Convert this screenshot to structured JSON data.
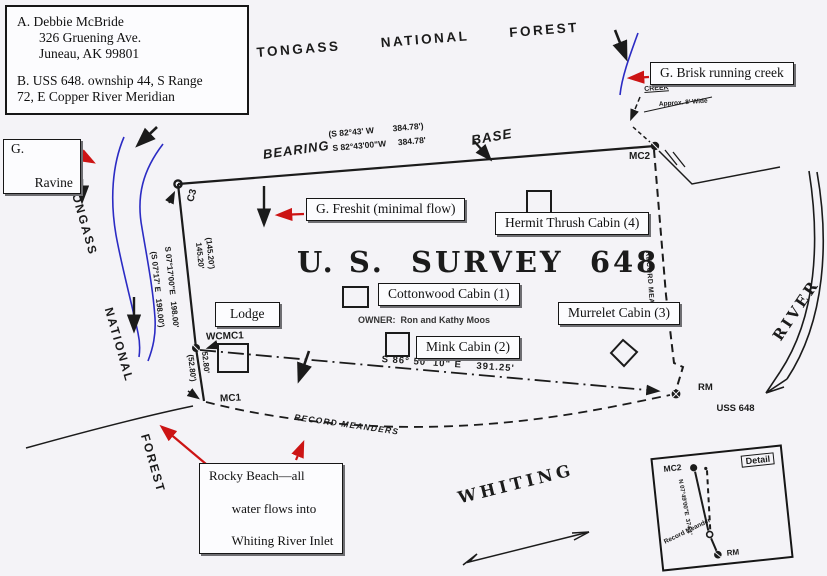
{
  "colors": {
    "paper": "#f4f3f7",
    "ink": "#1b1b1b",
    "creek_blue": "#2b2bc4",
    "leader_red": "#cc1414",
    "callout_bg": "#fcfcfe"
  },
  "info_box": {
    "a1": "A. Debbie McBride",
    "a2": "326 Gruening Ave.",
    "a3": "Juneau, AK 99801",
    "b1": "B. USS 648. ownship 44, S Range",
    "b2": "72, E    Copper River Meridian"
  },
  "forest": {
    "top": "TONGASS  NATIONAL  FOREST",
    "left": "TONGASS  NATIONAL  FOREST"
  },
  "callouts": {
    "ravine_1": "G.",
    "ravine_2": "Ravine",
    "brisk": "G. Brisk running creek",
    "freshit": "G. Freshit (minimal flow)",
    "rocky_1": "Rocky Beach—all",
    "rocky_2": "water flows into",
    "rocky_3": "Whiting River Inlet"
  },
  "buildings": {
    "lodge": "Lodge",
    "cottonwood": "Cottonwood Cabin (1)",
    "mink": "Mink Cabin (2)",
    "murrelet": "Murrelet Cabin (3)",
    "hermit": "Hermit Thrush Cabin (4)"
  },
  "survey": {
    "title": "U. S.  SURVEY  648",
    "owner": "OWNER:  Ron and Kathy Moos",
    "bearing_word": "BEARING",
    "base_word": "BASE",
    "base_bearing_paren": "(S 82°43' W        384.78')",
    "base_bearing": "S 82°43'00\"W     384.78'",
    "south_bearing": "S 86° 50' 10\" E    391.25'",
    "west_seg1_paren": "(145.20')",
    "west_seg1": "145.20'",
    "west_bearing": "S 07°17'00\"E   198.00'",
    "west_bearing_paren": "(S 07°17' E   198.00')",
    "west_seg2": "52.80'",
    "west_seg2_paren": "(52.80')",
    "c3": "C3",
    "mc2": "MC2",
    "mc1": "MC1",
    "wcmc1": "WCMC1",
    "rm_1": "RM",
    "rm_2": "USS 648",
    "record_mean_right": "RECORD MEAN",
    "record_meanders": "RECORD MEANDERS",
    "creek_note_1": "CREEK",
    "creek_note_2": "Approx. 8' Wide"
  },
  "water": {
    "whiting": "WHITING",
    "river": "RIVER"
  },
  "detail": {
    "label": "Detail",
    "mc2": "MC2",
    "rm": "RM",
    "bearing": "N 07°49'00\"E  374.1'",
    "meander": "Record Meander"
  }
}
